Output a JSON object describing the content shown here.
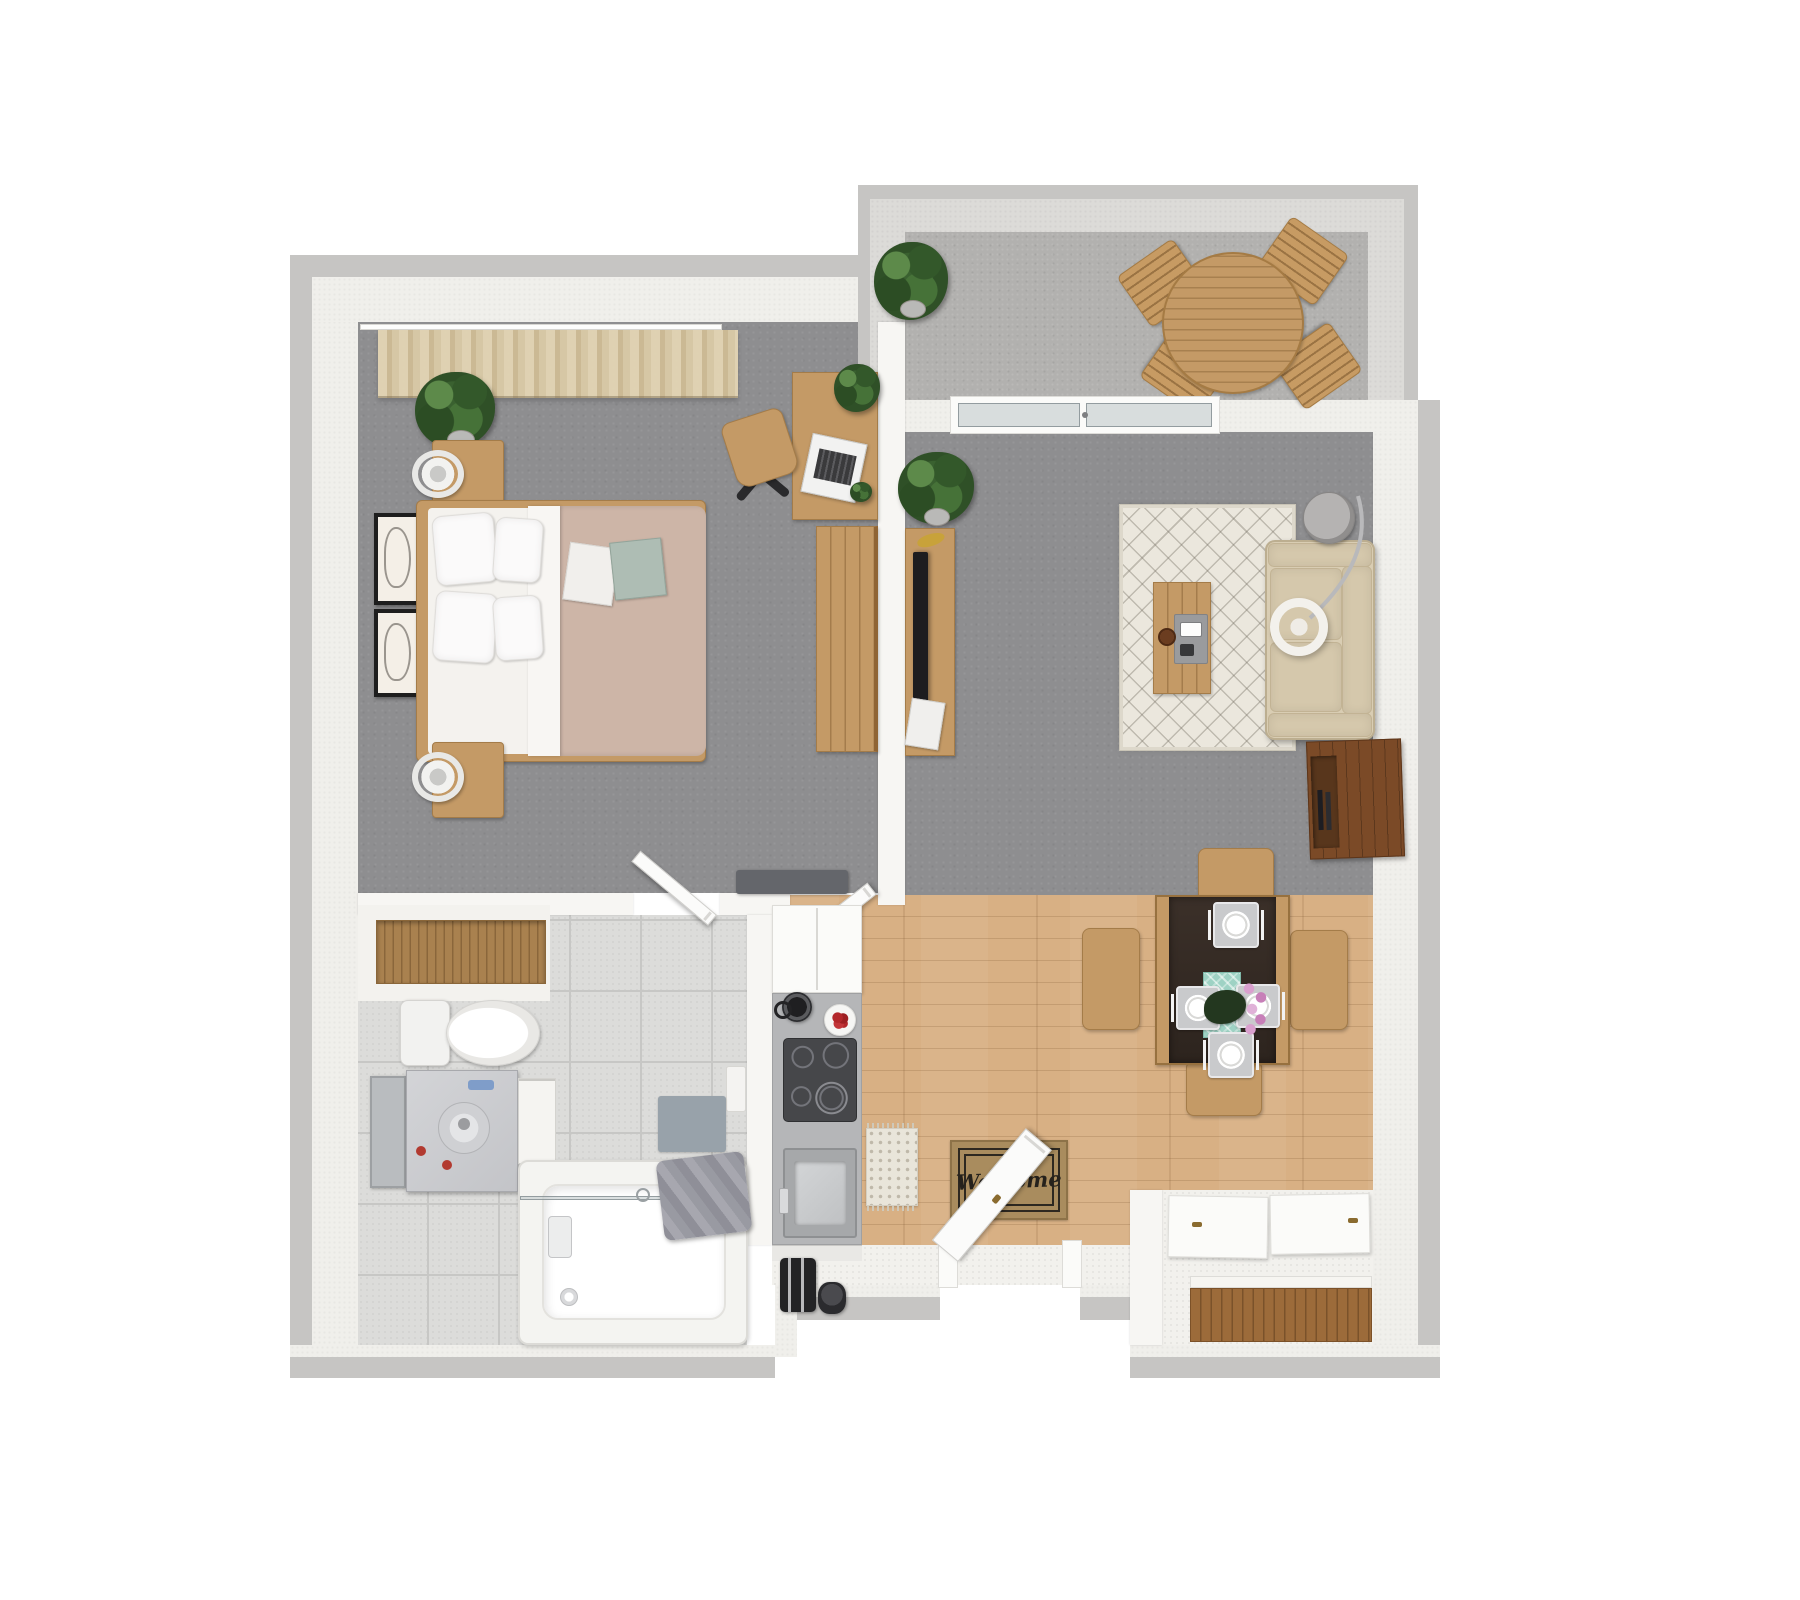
{
  "scene": {
    "description": "3D rendered top-down floor plan of a one-bedroom apartment with balcony",
    "entry": {
      "mat_text": "Welcome"
    },
    "rooms": [
      {
        "name": "bedroom",
        "floor": "gray carpet",
        "items": [
          "double bed",
          "white pillows",
          "tan duvet",
          "magazines",
          "nightstand north",
          "nightstand south",
          "two round table lamps",
          "two framed artworks",
          "potted plant",
          "window curtains",
          "desk",
          "laptop",
          "desk chair",
          "desk plant",
          "wardrobe",
          "wall ledge"
        ]
      },
      {
        "name": "living-room",
        "floor": "gray carpet",
        "items": [
          "beige tufted sofa",
          "arc floor lamp",
          "round side table",
          "wood coffee table",
          "tray with remote",
          "diamond pattern rug",
          "flat tv",
          "tv console",
          "magazine stack",
          "walnut media cabinet",
          "potted plant",
          "sliding balcony door"
        ]
      },
      {
        "name": "balcony",
        "floor": "concrete",
        "items": [
          "round slatted table",
          "four folding chairs",
          "potted plant"
        ]
      },
      {
        "name": "kitchen",
        "floor": "wood planks",
        "items": [
          "tall white cabinet",
          "gray counter",
          "kettle",
          "plate of tomatoes",
          "four burner cooktop",
          "stainless sink",
          "toaster",
          "coffee grinder",
          "patterned runner rug"
        ]
      },
      {
        "name": "dining-area",
        "floor": "wood planks",
        "items": [
          "dining table",
          "teal table runner",
          "four place settings",
          "leaf centerpiece",
          "pink orchid",
          "four wood chairs",
          "welcome mat",
          "open front door"
        ]
      },
      {
        "name": "bathroom",
        "floor": "gray tile",
        "items": [
          "toilet",
          "marble vanity with mirror door",
          "drawer unit",
          "bathtub with glass screen",
          "gray towels",
          "bath mat",
          "toilet paper holder",
          "linen closet wood shelf",
          "open bathroom door"
        ]
      },
      {
        "name": "entry-closet",
        "floor": "white",
        "items": [
          "two white sliding doors",
          "wood storage shelf"
        ]
      }
    ],
    "colors": {
      "background": "#ffffff",
      "wall_edge": "#c6c5c3",
      "wall_face": "#f0efeb",
      "carpet": "#8e8e90",
      "concrete": "#b2b1af",
      "wood_floor": "#d8b084",
      "tile": "#dcdcda",
      "oak_furniture": "#c49a66",
      "walnut_cabinet": "#7b4a27",
      "sofa_beige": "#d9cdb3",
      "rug_cream": "#ebe7dd",
      "duvet_tan": "#cdb5a7",
      "runner_teal": "#9ed2c4",
      "mat_tan": "#a98c5e",
      "plant_green": "#3a6130",
      "accent_red": "#b3272a",
      "orchid_pink": "#d9a0ce"
    }
  }
}
